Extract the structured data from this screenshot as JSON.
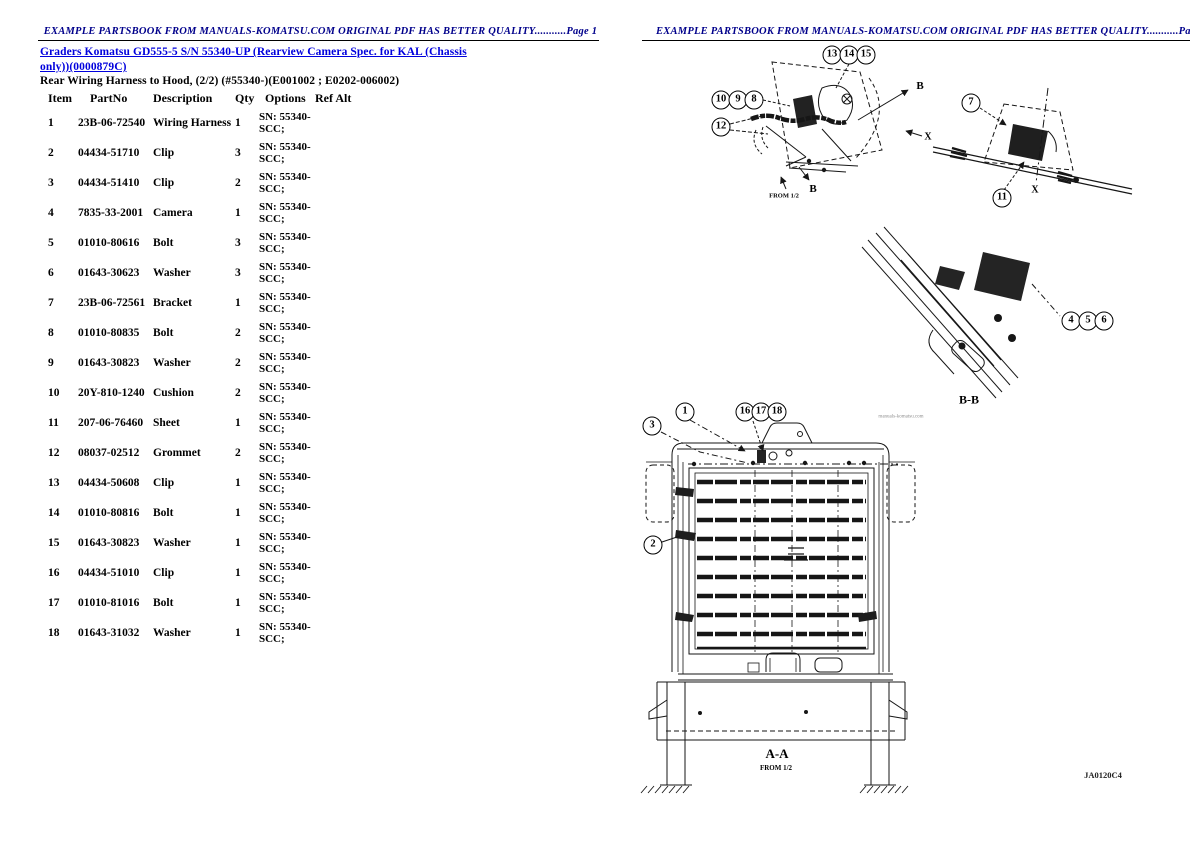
{
  "palette": {
    "header_color": "#00008b",
    "link_color": "#0000dd",
    "text_color": "#000000",
    "line_color": "#161616",
    "watermark_color": "#8f8f8f"
  },
  "page1": {
    "header": "EXAMPLE PARTSBOOK FROM MANUALS-KOMATSU.COM ORIGINAL PDF HAS BETTER QUALITY...........Page 1",
    "title_link": {
      "line1": "Graders Komatsu GD555-5 S/N 55340-UP (Rearview Camera Spec. for KAL (Chassis",
      "line2": "only))(0000879C)"
    },
    "subtitle": "Rear Wiring Harness to Hood, (2/2) (#55340-)(E001002 ; E0202-006002)",
    "table": {
      "columns": [
        "Item",
        "PartNo",
        "Description",
        "Qty",
        "Options",
        "Ref Alt"
      ],
      "rows": [
        [
          "1",
          "23B-06-72540",
          "Wiring Harness",
          "1",
          "SN: 55340-",
          "SCC;"
        ],
        [
          "2",
          "04434-51710",
          "Clip",
          "3",
          "SN: 55340-",
          "SCC;"
        ],
        [
          "3",
          "04434-51410",
          "Clip",
          "2",
          "SN: 55340-",
          "SCC;"
        ],
        [
          "4",
          "7835-33-2001",
          "Camera",
          "1",
          "SN: 55340-",
          "SCC;"
        ],
        [
          "5",
          "01010-80616",
          "Bolt",
          "3",
          "SN: 55340-",
          "SCC;"
        ],
        [
          "6",
          "01643-30623",
          "Washer",
          "3",
          "SN: 55340-",
          "SCC;"
        ],
        [
          "7",
          "23B-06-72561",
          "Bracket",
          "1",
          "SN: 55340-",
          "SCC;"
        ],
        [
          "8",
          "01010-80835",
          "Bolt",
          "2",
          "SN: 55340-",
          "SCC;"
        ],
        [
          "9",
          "01643-30823",
          "Washer",
          "2",
          "SN: 55340-",
          "SCC;"
        ],
        [
          "10",
          "20Y-810-1240",
          "Cushion",
          "2",
          "SN: 55340-",
          "SCC;"
        ],
        [
          "11",
          "207-06-76460",
          "Sheet",
          "1",
          "SN: 55340-",
          "SCC;"
        ],
        [
          "12",
          "08037-02512",
          "Grommet",
          "2",
          "SN: 55340-",
          "SCC;"
        ],
        [
          "13",
          "04434-50608",
          "Clip",
          "1",
          "SN: 55340-",
          "SCC;"
        ],
        [
          "14",
          "01010-80816",
          "Bolt",
          "1",
          "SN: 55340-",
          "SCC;"
        ],
        [
          "15",
          "01643-30823",
          "Washer",
          "1",
          "SN: 55340-",
          "SCC;"
        ],
        [
          "16",
          "04434-51010",
          "Clip",
          "1",
          "SN: 55340-",
          "SCC;"
        ],
        [
          "17",
          "01010-81016",
          "Bolt",
          "1",
          "SN: 55340-",
          "SCC;"
        ],
        [
          "18",
          "01643-31032",
          "Washer",
          "1",
          "SN: 55340-",
          "SCC;"
        ]
      ]
    }
  },
  "page2": {
    "header": "EXAMPLE PARTSBOOK FROM MANUALS-KOMATSU.COM ORIGINAL PDF HAS BETTER QUALITY...........Page 2",
    "callouts": [
      {
        "n": "13",
        "x": 832,
        "y": 55
      },
      {
        "n": "14",
        "x": 849,
        "y": 55
      },
      {
        "n": "15",
        "x": 866,
        "y": 55
      },
      {
        "n": "10",
        "x": 721,
        "y": 100
      },
      {
        "n": "9",
        "x": 738,
        "y": 100
      },
      {
        "n": "8",
        "x": 754,
        "y": 100
      },
      {
        "n": "12",
        "x": 721,
        "y": 127
      },
      {
        "n": "7",
        "x": 971,
        "y": 103
      },
      {
        "n": "11",
        "x": 1002,
        "y": 198
      },
      {
        "n": "4",
        "x": 1071,
        "y": 321
      },
      {
        "n": "5",
        "x": 1088,
        "y": 321
      },
      {
        "n": "6",
        "x": 1104,
        "y": 321
      },
      {
        "n": "3",
        "x": 652,
        "y": 426
      },
      {
        "n": "1",
        "x": 685,
        "y": 412
      },
      {
        "n": "16",
        "x": 745,
        "y": 412
      },
      {
        "n": "17",
        "x": 761,
        "y": 412
      },
      {
        "n": "18",
        "x": 777,
        "y": 412
      },
      {
        "n": "2",
        "x": 653,
        "y": 545
      }
    ],
    "labels": [
      {
        "name": "section-arrow-label-b-top",
        "text": "B",
        "x": 920,
        "y": 86,
        "size": 11
      },
      {
        "name": "section-arrow-label-b-bottom",
        "text": "B",
        "x": 813,
        "y": 189,
        "size": 11
      },
      {
        "name": "from-ref-label-fig1",
        "text": "FROM 1/2",
        "x": 784,
        "y": 196,
        "size": 6.5
      },
      {
        "name": "section-arrow-label-x-left",
        "text": "X",
        "x": 928,
        "y": 137,
        "size": 10
      },
      {
        "name": "section-arrow-label-x-bottom",
        "text": "X",
        "x": 1035,
        "y": 190,
        "size": 10
      },
      {
        "name": "section-title-b-b",
        "text": "B-B",
        "x": 969,
        "y": 400,
        "size": 12
      },
      {
        "name": "section-title-a-a",
        "text": "A-A",
        "x": 777,
        "y": 754,
        "size": 13
      },
      {
        "name": "from-ref-label-fig4",
        "text": "FROM 1/2",
        "x": 776,
        "y": 768,
        "size": 7
      },
      {
        "name": "watermark-text",
        "text": "manuals-komatsu.com",
        "x": 901,
        "y": 417,
        "size": 5,
        "color": "#8f8f8f",
        "weight": "normal"
      },
      {
        "name": "figure-code",
        "text": "JA0120C4",
        "x": 1103,
        "y": 775,
        "size": 8.5,
        "color": "#222222"
      }
    ]
  }
}
